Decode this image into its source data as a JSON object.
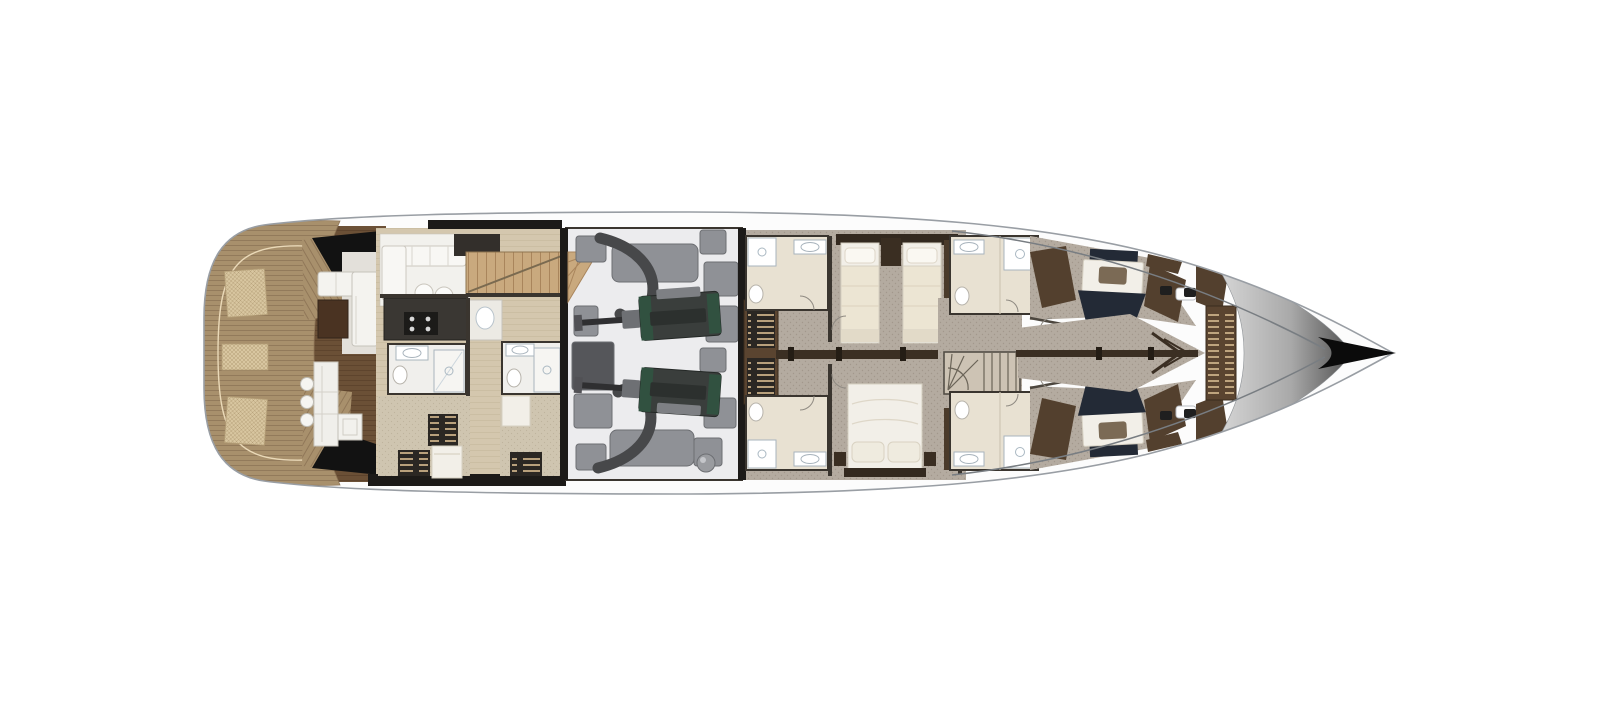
{
  "plan": {
    "kind": "motor-yacht-lower-deck-floor-plan",
    "orientation": "bow-right",
    "regions": [
      "swim-platform",
      "sun-pad-hatches",
      "beach-club-lounge",
      "beach-club-bar",
      "crew-mess",
      "crew-galley",
      "crew-bathroom-left",
      "crew-bathroom-right",
      "crew-cabin-lower-left",
      "crew-cabin-lower-right",
      "crew-stairs",
      "engine-room",
      "engine-upper",
      "engine-lower",
      "generators-and-equipment",
      "guest-bathroom-midship-upper",
      "guest-bathroom-midship-lower",
      "side-stair-band",
      "corridor",
      "twin-guest-cabin",
      "vip-double-cabin",
      "main-staircase",
      "guest-bathroom-forward-upper",
      "guest-bathroom-forward-lower",
      "forward-cabin-upper",
      "forward-cabin-lower",
      "bow-corridor",
      "anchor-locker-ladder",
      "foredeck",
      "bow-tip"
    ]
  },
  "palette": {
    "background": "#ffffff",
    "hull_fill": "#fcfcfc",
    "hull_stroke": "#999ea4",
    "inner_line": "#787d82",
    "teak": "#a8906c",
    "teak_line": "#8d7456",
    "hatch_bg": "#d8c6a0",
    "hatch_line": "#b39d76",
    "beach_wood": "#6b5036",
    "beach_wood_line": "#583f29",
    "crew_floor": "#d4c7ae",
    "crew_floor_line": "#c6b89c",
    "white_room": "#f2f1ed",
    "fixture": "#ffffff",
    "fixture_stroke": "#a9b4bd",
    "wall": "#3a352f",
    "wall_dark": "#1c1a18",
    "counter_dark": "#3a3733",
    "stairs_tan": "#c9a97e",
    "stairs_line": "#a9855c",
    "engine_floor": "#ececee",
    "equip": "#8f9196",
    "equip_stroke": "#6c6e72",
    "equip_dark": "#55565a",
    "engine_body": "#3a3e3c",
    "engine_green": "#315140",
    "pipe": "#47484a",
    "carpet": "#b4aba0",
    "carpet_dot": "#a2988c",
    "carpet_beige": "#cfc5b0",
    "wood_trim": "#53402e",
    "wood_trim_dark": "#3a2c1e",
    "rail": "#3b2f23",
    "bed_white": "#f2efe8",
    "bed_stroke": "#d6d0c2",
    "bed_cream": "#ece5d3",
    "pillow_brown": "#7b6a55",
    "bed_navy": "#232a36",
    "headboard": "#33291f",
    "travertine": "#e8e1d2",
    "ladder_bg": "#2b2723",
    "ladder_rung": "#cdb289",
    "stairband_wood": "#5a4430",
    "bow_wood": "#53402e",
    "bow_grad_light": "#d8d8d8",
    "bow_grad_dark": "#4f4f4f",
    "bow_tip": "#0b0b0b",
    "glass_black": "#121212"
  }
}
